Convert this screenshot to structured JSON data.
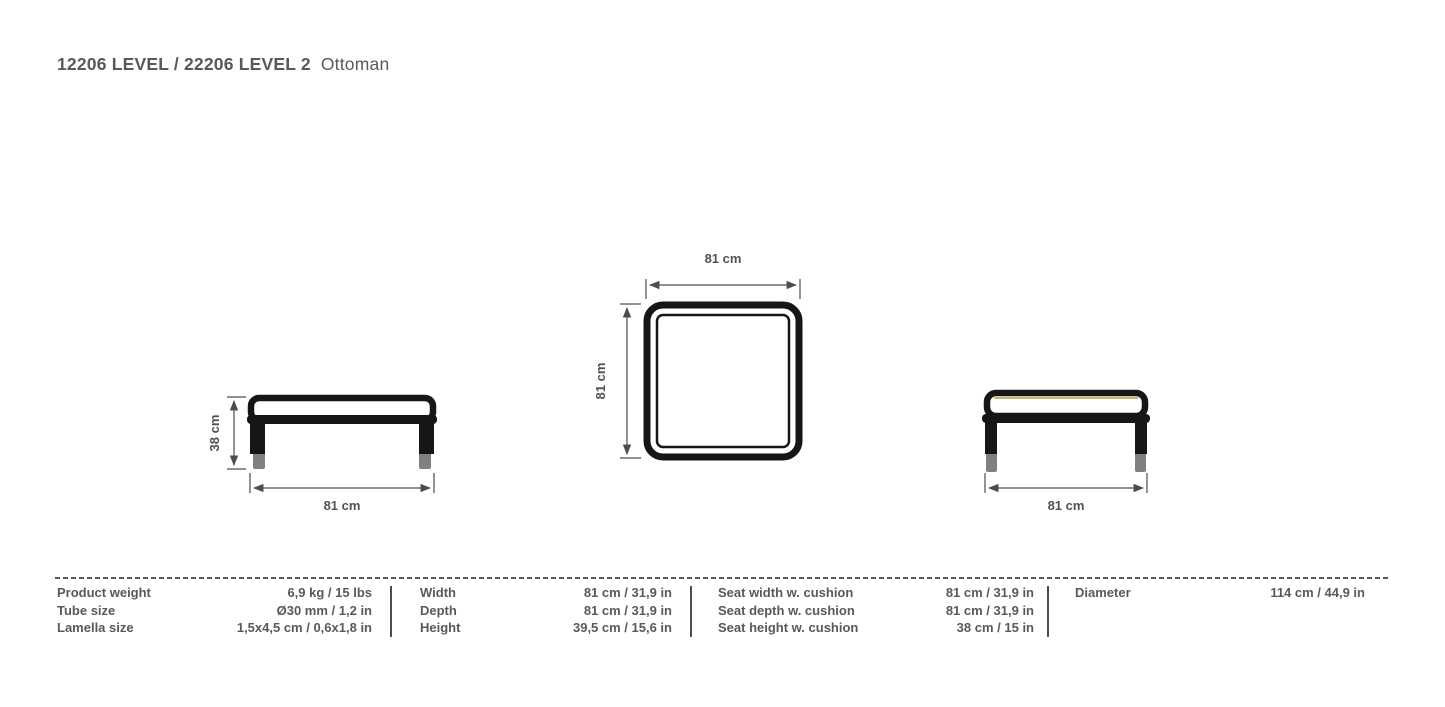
{
  "title": {
    "code_part": "12206 LEVEL / 22206 LEVEL 2",
    "name_part": "Ottoman"
  },
  "drawings": {
    "side_view": {
      "height_dim": "38 cm",
      "width_dim": "81 cm"
    },
    "top_view": {
      "width_dim": "81 cm",
      "depth_dim": "81 cm"
    },
    "front_view": {
      "width_dim": "81 cm"
    }
  },
  "spec_table": {
    "groups": [
      {
        "rows": [
          {
            "label": "Product weight",
            "value": "6,9 kg / 15 lbs"
          },
          {
            "label": "Tube size",
            "value": "Ø30 mm / 1,2 in"
          },
          {
            "label": "Lamella size",
            "value": "1,5x4,5 cm / 0,6x1,8 in"
          }
        ]
      },
      {
        "rows": [
          {
            "label": "Width",
            "value": "81 cm / 31,9 in"
          },
          {
            "label": "Depth",
            "value": "81 cm / 31,9 in"
          },
          {
            "label": "Height",
            "value": "39,5 cm / 15,6 in"
          }
        ]
      },
      {
        "rows": [
          {
            "label": "Seat width w. cushion",
            "value": "81 cm / 31,9 in"
          },
          {
            "label": "Seat depth w. cushion",
            "value": "81 cm / 31,9 in"
          },
          {
            "label": "Seat height w. cushion",
            "value": "38 cm / 15 in"
          }
        ]
      },
      {
        "rows": [
          {
            "label": "Diameter",
            "value": "114 cm / 44,9 in"
          }
        ]
      }
    ]
  },
  "colors": {
    "text": "#58595B",
    "line": "#161617",
    "dimension": "#4D4D4F",
    "accent_yellow": "#B3A433",
    "foot_gray": "#808084",
    "background": "#FFFFFF"
  }
}
